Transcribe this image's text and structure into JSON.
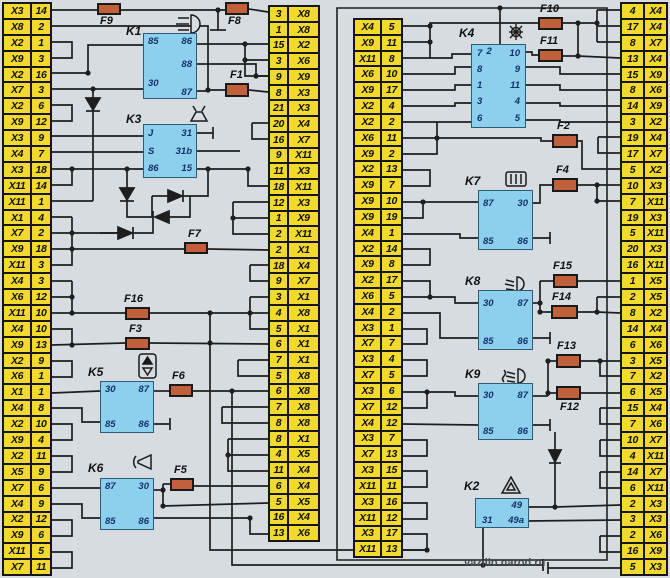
{
  "diagram_title": "Vehicle relay and fuse box wiring diagram",
  "watermark": "vazillo.narod.ru",
  "colors": {
    "strip_yellow": "#f2d92e",
    "relay_blue": "#8dd0ee",
    "fuse_orange": "#c2603b",
    "wire": "#1e1e1e",
    "background": "#d7dce1"
  },
  "strips": {
    "left": [
      [
        "X3",
        "14"
      ],
      [
        "X8",
        "2"
      ],
      [
        "X2",
        "1"
      ],
      [
        "X9",
        "3"
      ],
      [
        "X2",
        "16"
      ],
      [
        "X7",
        "3"
      ],
      [
        "X2",
        "6"
      ],
      [
        "X9",
        "12"
      ],
      [
        "X3",
        "9"
      ],
      [
        "X4",
        "7"
      ],
      [
        "X3",
        "18"
      ],
      [
        "X11",
        "14"
      ],
      [
        "X11",
        "1"
      ],
      [
        "X1",
        "4"
      ],
      [
        "X7",
        "2"
      ],
      [
        "X9",
        "18"
      ],
      [
        "X11",
        "3"
      ],
      [
        "X4",
        "3"
      ],
      [
        "X6",
        "12"
      ],
      [
        "X11",
        "10"
      ],
      [
        "X4",
        "10"
      ],
      [
        "X9",
        "13"
      ],
      [
        "X2",
        "9"
      ],
      [
        "X6",
        "1"
      ],
      [
        "X1",
        "1"
      ],
      [
        "X4",
        "8"
      ],
      [
        "X2",
        "10"
      ],
      [
        "X9",
        "4"
      ],
      [
        "X2",
        "11"
      ],
      [
        "X5",
        "9"
      ],
      [
        "X7",
        "6"
      ],
      [
        "X4",
        "9"
      ],
      [
        "X2",
        "12"
      ],
      [
        "X9",
        "6"
      ],
      [
        "X11",
        "5"
      ],
      [
        "X7",
        "11"
      ]
    ],
    "mid_left": [
      [
        "3",
        "X8"
      ],
      [
        "1",
        "X8"
      ],
      [
        "15",
        "X2"
      ],
      [
        "3",
        "X6"
      ],
      [
        "9",
        "X9"
      ],
      [
        "8",
        "X3"
      ],
      [
        "21",
        "X3"
      ],
      [
        "20",
        "X4"
      ],
      [
        "16",
        "X7"
      ],
      [
        "9",
        "X11"
      ],
      [
        "11",
        "X3"
      ],
      [
        "18",
        "X11"
      ],
      [
        "12",
        "X3"
      ],
      [
        "1",
        "X9"
      ],
      [
        "2",
        "X11"
      ],
      [
        "2",
        "X1"
      ],
      [
        "18",
        "X4"
      ],
      [
        "9",
        "X7"
      ],
      [
        "3",
        "X1"
      ],
      [
        "4",
        "X8"
      ],
      [
        "5",
        "X1"
      ],
      [
        "6",
        "X1"
      ],
      [
        "7",
        "X1"
      ],
      [
        "5",
        "X8"
      ],
      [
        "6",
        "X8"
      ],
      [
        "7",
        "X8"
      ],
      [
        "8",
        "X8"
      ],
      [
        "8",
        "X1"
      ],
      [
        "4",
        "X5"
      ],
      [
        "11",
        "X4"
      ],
      [
        "6",
        "X4"
      ],
      [
        "5",
        "X5"
      ],
      [
        "16",
        "X4"
      ],
      [
        "13",
        "X6"
      ]
    ],
    "mid_right": [
      [
        "X4",
        "5"
      ],
      [
        "X9",
        "11"
      ],
      [
        "X11",
        "8"
      ],
      [
        "X6",
        "10"
      ],
      [
        "X9",
        "17"
      ],
      [
        "X2",
        "4"
      ],
      [
        "X2",
        "2"
      ],
      [
        "X6",
        "11"
      ],
      [
        "X9",
        "2"
      ],
      [
        "X2",
        "13"
      ],
      [
        "X9",
        "7"
      ],
      [
        "X9",
        "10"
      ],
      [
        "X9",
        "19"
      ],
      [
        "X4",
        "1"
      ],
      [
        "X2",
        "14"
      ],
      [
        "X9",
        "8"
      ],
      [
        "X2",
        "17"
      ],
      [
        "X6",
        "5"
      ],
      [
        "X4",
        "2"
      ],
      [
        "X3",
        "1"
      ],
      [
        "X7",
        "7"
      ],
      [
        "X3",
        "4"
      ],
      [
        "X7",
        "5"
      ],
      [
        "X3",
        "6"
      ],
      [
        "X7",
        "12"
      ],
      [
        "X4",
        "12"
      ],
      [
        "X3",
        "7"
      ],
      [
        "X7",
        "13"
      ],
      [
        "X3",
        "15"
      ],
      [
        "X11",
        "11"
      ],
      [
        "X3",
        "16"
      ],
      [
        "X11",
        "12"
      ],
      [
        "X3",
        "17"
      ],
      [
        "X11",
        "13"
      ]
    ],
    "right": [
      [
        "4",
        "X4"
      ],
      [
        "17",
        "X4"
      ],
      [
        "8",
        "X7"
      ],
      [
        "13",
        "X4"
      ],
      [
        "15",
        "X9"
      ],
      [
        "8",
        "X6"
      ],
      [
        "14",
        "X9"
      ],
      [
        "3",
        "X2"
      ],
      [
        "19",
        "X4"
      ],
      [
        "17",
        "X7"
      ],
      [
        "5",
        "X2"
      ],
      [
        "10",
        "X3"
      ],
      [
        "7",
        "X11"
      ],
      [
        "19",
        "X3"
      ],
      [
        "5",
        "X11"
      ],
      [
        "20",
        "X3"
      ],
      [
        "16",
        "X11"
      ],
      [
        "1",
        "X5"
      ],
      [
        "2",
        "X5"
      ],
      [
        "8",
        "X2"
      ],
      [
        "14",
        "X4"
      ],
      [
        "6",
        "X6"
      ],
      [
        "3",
        "X5"
      ],
      [
        "7",
        "X2"
      ],
      [
        "6",
        "X5"
      ],
      [
        "15",
        "X4"
      ],
      [
        "7",
        "X6"
      ],
      [
        "10",
        "X7"
      ],
      [
        "4",
        "X11"
      ],
      [
        "14",
        "X7"
      ],
      [
        "6",
        "X11"
      ],
      [
        "2",
        "X3"
      ],
      [
        "3",
        "X3"
      ],
      [
        "2",
        "X6"
      ],
      [
        "16",
        "X9"
      ],
      [
        "5",
        "X3"
      ]
    ]
  },
  "relays": {
    "K1": {
      "label": "K1",
      "pins": {
        "tl": "85",
        "tr": "86",
        "r": "88",
        "bl": "30",
        "br": "87"
      }
    },
    "K3": {
      "label": "K3",
      "rows": [
        [
          "J",
          "31"
        ],
        [
          "S",
          "31b"
        ],
        [
          "86",
          "15"
        ]
      ]
    },
    "K5": {
      "label": "K5",
      "pins": {
        "tl": "30",
        "tr": "87",
        "bl": "85",
        "br": "86"
      }
    },
    "K6": {
      "label": "K6",
      "pins": {
        "tl": "87",
        "tr": "30",
        "bl": "85",
        "br": "86"
      }
    },
    "K4": {
      "label": "K4",
      "top": "2",
      "left": [
        "7",
        "8",
        "1",
        "3",
        "6"
      ],
      "right": [
        "10",
        "9",
        "11",
        "4",
        "5"
      ]
    },
    "K7": {
      "label": "K7",
      "pins": {
        "tl": "87",
        "tr": "30",
        "bl": "85",
        "br": "86"
      }
    },
    "K8": {
      "label": "K8",
      "pins": {
        "tl": "30",
        "tr": "87",
        "bl": "85",
        "br": "86"
      }
    },
    "K9": {
      "label": "K9",
      "pins": {
        "tl": "30",
        "tr": "87",
        "bl": "85",
        "br": "86"
      }
    },
    "K2": {
      "label": "K2",
      "pins": {
        "tr": "49",
        "bl": "31",
        "br": "49a"
      }
    }
  },
  "fuses": {
    "F1": "F1",
    "F2": "F2",
    "F3": "F3",
    "F4": "F4",
    "F5": "F5",
    "F6": "F6",
    "F7": "F7",
    "F8": "F8",
    "F9": "F9",
    "F10": "F10",
    "F11": "F11",
    "F12": "F12",
    "F13": "F13",
    "F14": "F14",
    "F15": "F15",
    "F16": "F16"
  },
  "icons": {
    "k1": "high-beam-icon",
    "k3": "washer-icon",
    "k5": "window-lift-icon",
    "k6": "horn-icon",
    "k4": "bulb-icon",
    "k7": "rear-defogger-icon",
    "k8": "low-beam-icon",
    "k9": "fog-light-icon",
    "k2": "hazard-triangle-icon"
  }
}
